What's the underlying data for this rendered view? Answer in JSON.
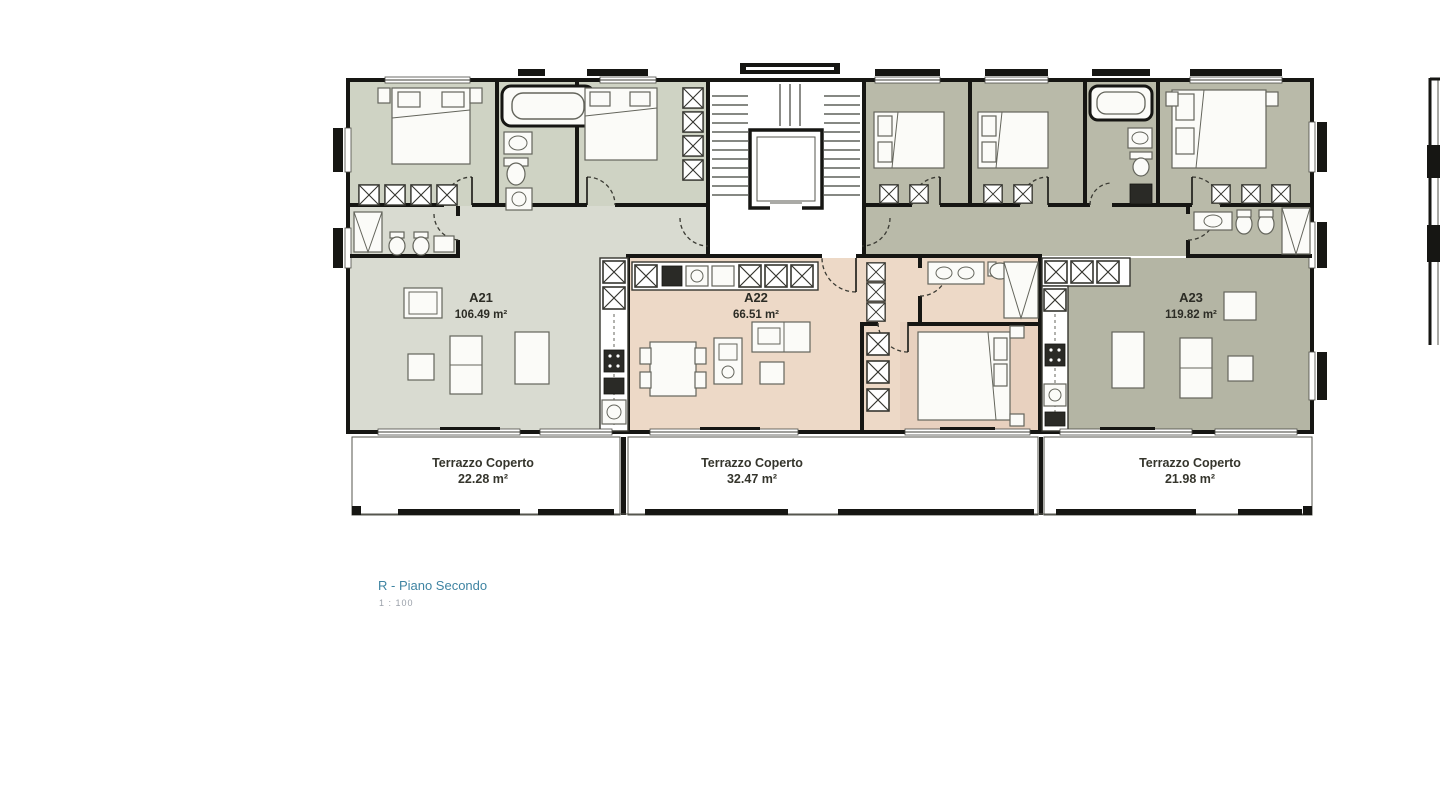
{
  "plan": {
    "floor_label": "R - Piano Secondo",
    "scale_label": "1 : 100",
    "apartments": [
      {
        "id": "A21",
        "area": "106.49 m²"
      },
      {
        "id": "A22",
        "area": "66.51 m²"
      },
      {
        "id": "A23",
        "area": "119.82 m²"
      }
    ],
    "terraces": [
      {
        "label": "Terrazzo Coperto",
        "area": "22.28 m²"
      },
      {
        "label": "Terrazzo Coperto",
        "area": "32.47 m²"
      },
      {
        "label": "Terrazzo Coperto",
        "area": "21.98 m²"
      }
    ],
    "colors": {
      "a21_room_fill": "#cfd3c4",
      "a21_living_fill": "#d9dbd1",
      "a22_fill": "#edd9c7",
      "a22_bedroom_fill": "#e8d1bf",
      "a23_room_fill": "#b9baa9",
      "a23_living_fill": "#b4b5a4",
      "terrace_fill": "#d8c9a1",
      "wall_color": "#161613",
      "floor_label_color": "#3f84a2",
      "scale_label_color": "#9aa0a9"
    }
  }
}
